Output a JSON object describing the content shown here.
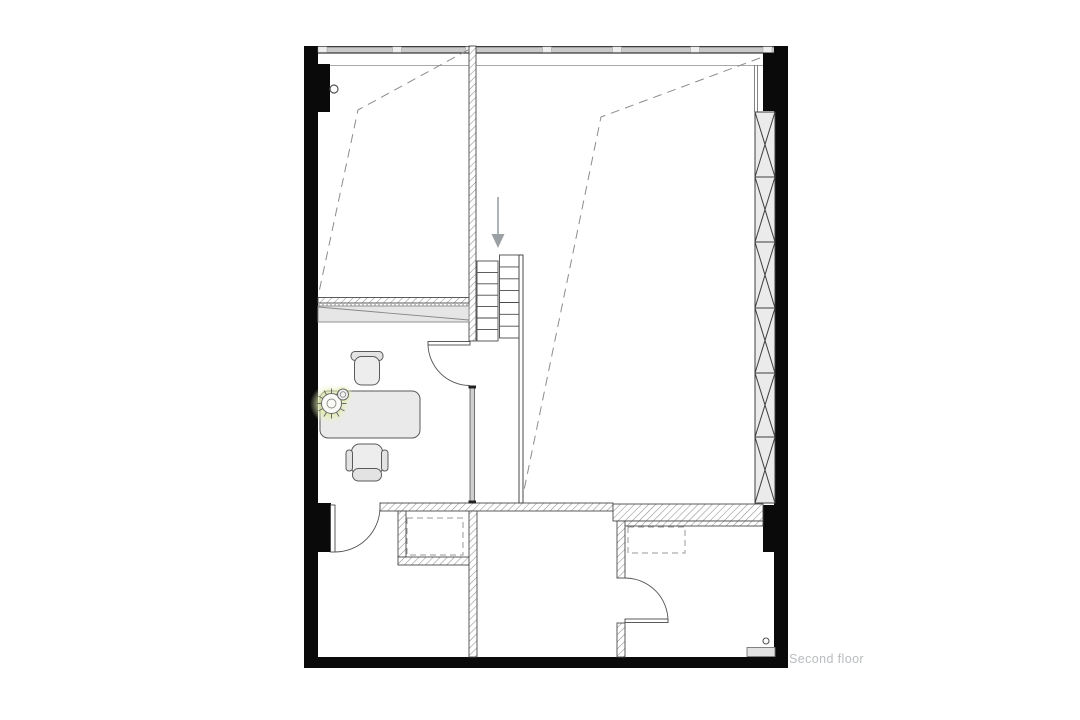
{
  "page": {
    "background": "#ffffff"
  },
  "floor_plan": {
    "label": "Second floor",
    "label_color": "#b9bcbe",
    "colors": {
      "wall_black": "#0a0a0a",
      "hatch_line": "#8f8f8f",
      "outline": "#4a4a4a",
      "dashed_void_line": "#8c8c8c",
      "dashed_closet_line": "#9a9a9a",
      "window_band_fill": "#c9c9c9",
      "window_mullion_fill": "#efefef",
      "glazing_panel_fill": "#ebebeb",
      "furniture_fill": "#ececec",
      "furniture_stroke": "#5a5a5a",
      "sliding_panel_fill": "#e6e6e6",
      "plant_glow": "#d9e89c",
      "stairs_arrow": "#9aa0a3"
    },
    "stairs": {
      "flights": 2,
      "treads_per_flight": 7,
      "direction": "down"
    },
    "icons": {
      "stairs_arrow": "down-arrow",
      "plant": "potted-plant",
      "doors": "quarter-arc-swing"
    }
  }
}
